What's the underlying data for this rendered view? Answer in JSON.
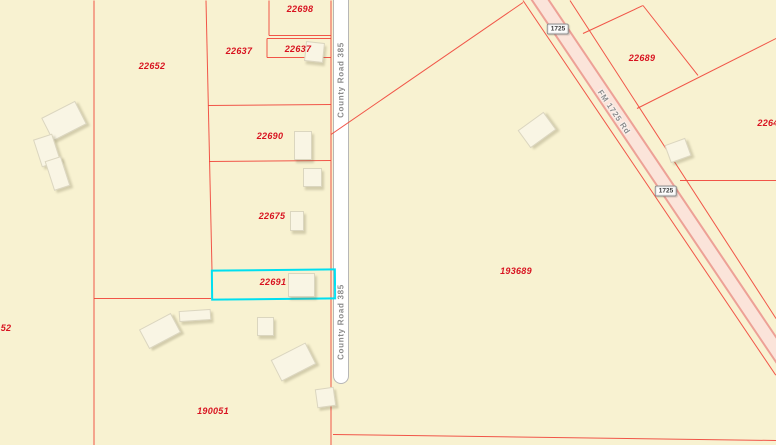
{
  "map": {
    "background": "#f8f2d1",
    "parcel_line_color": "#f0483c",
    "parcel_label_color": "#d81320",
    "highlight_color": "#00dff0",
    "parcel_labels": [
      {
        "text": "22652",
        "x": 152,
        "y": 66
      },
      {
        "text": "22637",
        "x": 239,
        "y": 51
      },
      {
        "text": "22698",
        "x": 300,
        "y": 9
      },
      {
        "text": "22637",
        "x": 298,
        "y": 49
      },
      {
        "text": "22690",
        "x": 270,
        "y": 136
      },
      {
        "text": "22675",
        "x": 272,
        "y": 216
      },
      {
        "text": "22691",
        "x": 273,
        "y": 282,
        "highlighted": true
      },
      {
        "text": "190051",
        "x": 213,
        "y": 411
      },
      {
        "text": "193689",
        "x": 516,
        "y": 271
      },
      {
        "text": "22689",
        "x": 642,
        "y": 58
      },
      {
        "text": "2264",
        "x": 768,
        "y": 123,
        "clipped": "right"
      },
      {
        "text": "52",
        "x": 6,
        "y": 328,
        "clipped": "left"
      }
    ],
    "highlight_parcel": {
      "id": "22691",
      "x": 211,
      "y": 269,
      "width": 121,
      "height": 27
    },
    "boundary_lines": [
      [
        94,
        0,
        94,
        445
      ],
      [
        206,
        0,
        212,
        270
      ],
      [
        94,
        298,
        211,
        298
      ],
      [
        269,
        0,
        269,
        35
      ],
      [
        269,
        35,
        331,
        35
      ],
      [
        267,
        38,
        267,
        57
      ],
      [
        267,
        38,
        331,
        38
      ],
      [
        267,
        57,
        331,
        57
      ],
      [
        208,
        105,
        331,
        104
      ],
      [
        209,
        161,
        331,
        160
      ],
      [
        331,
        0,
        331,
        445
      ],
      [
        331,
        134,
        523,
        2
      ],
      [
        523,
        0,
        776,
        375
      ],
      [
        570,
        0,
        776,
        318
      ],
      [
        583,
        33,
        643,
        5
      ],
      [
        643,
        5,
        698,
        75
      ],
      [
        637,
        108,
        776,
        38
      ],
      [
        680,
        180,
        776,
        180
      ],
      [
        333,
        434,
        776,
        440
      ]
    ],
    "roads": {
      "county_road": {
        "name": "County Road 385",
        "fill": "#ffffff",
        "casing": "#b7b7b7",
        "label_color": "#8c8c8c",
        "labels": [
          {
            "x": 341,
            "y": 80
          },
          {
            "x": 341,
            "y": 322
          }
        ]
      },
      "fm_road": {
        "name": "FM 1725 Rd",
        "fill": "#fbe4da",
        "casing": "#eda196",
        "label_color": "#8c8c8c",
        "label": {
          "x": 614,
          "y": 112,
          "angle": 56
        },
        "shield_text": "1725",
        "shields": [
          {
            "x": 558,
            "y": 29
          },
          {
            "x": 666,
            "y": 191
          }
        ]
      }
    },
    "buildings": [
      {
        "x": 45,
        "y": 108,
        "w": 36,
        "h": 24,
        "r": -27
      },
      {
        "x": 37,
        "y": 136,
        "w": 18,
        "h": 27,
        "r": -18
      },
      {
        "x": 49,
        "y": 158,
        "w": 15,
        "h": 29,
        "r": -18
      },
      {
        "x": 305,
        "y": 42,
        "w": 17,
        "h": 18,
        "r": 6
      },
      {
        "x": 294,
        "y": 131,
        "w": 16,
        "h": 27,
        "r": 0
      },
      {
        "x": 303,
        "y": 168,
        "w": 17,
        "h": 17,
        "r": 0
      },
      {
        "x": 290,
        "y": 211,
        "w": 12,
        "h": 18,
        "r": 0
      },
      {
        "x": 288,
        "y": 273,
        "w": 25,
        "h": 22,
        "r": 0
      },
      {
        "x": 179,
        "y": 310,
        "w": 30,
        "h": 9,
        "r": -4
      },
      {
        "x": 142,
        "y": 320,
        "w": 34,
        "h": 20,
        "r": -28
      },
      {
        "x": 257,
        "y": 317,
        "w": 15,
        "h": 17,
        "r": 0
      },
      {
        "x": 274,
        "y": 350,
        "w": 37,
        "h": 22,
        "r": -27
      },
      {
        "x": 316,
        "y": 388,
        "w": 17,
        "h": 17,
        "r": -8
      },
      {
        "x": 521,
        "y": 119,
        "w": 30,
        "h": 20,
        "r": -36
      },
      {
        "x": 667,
        "y": 141,
        "w": 20,
        "h": 17,
        "r": -20
      }
    ]
  }
}
